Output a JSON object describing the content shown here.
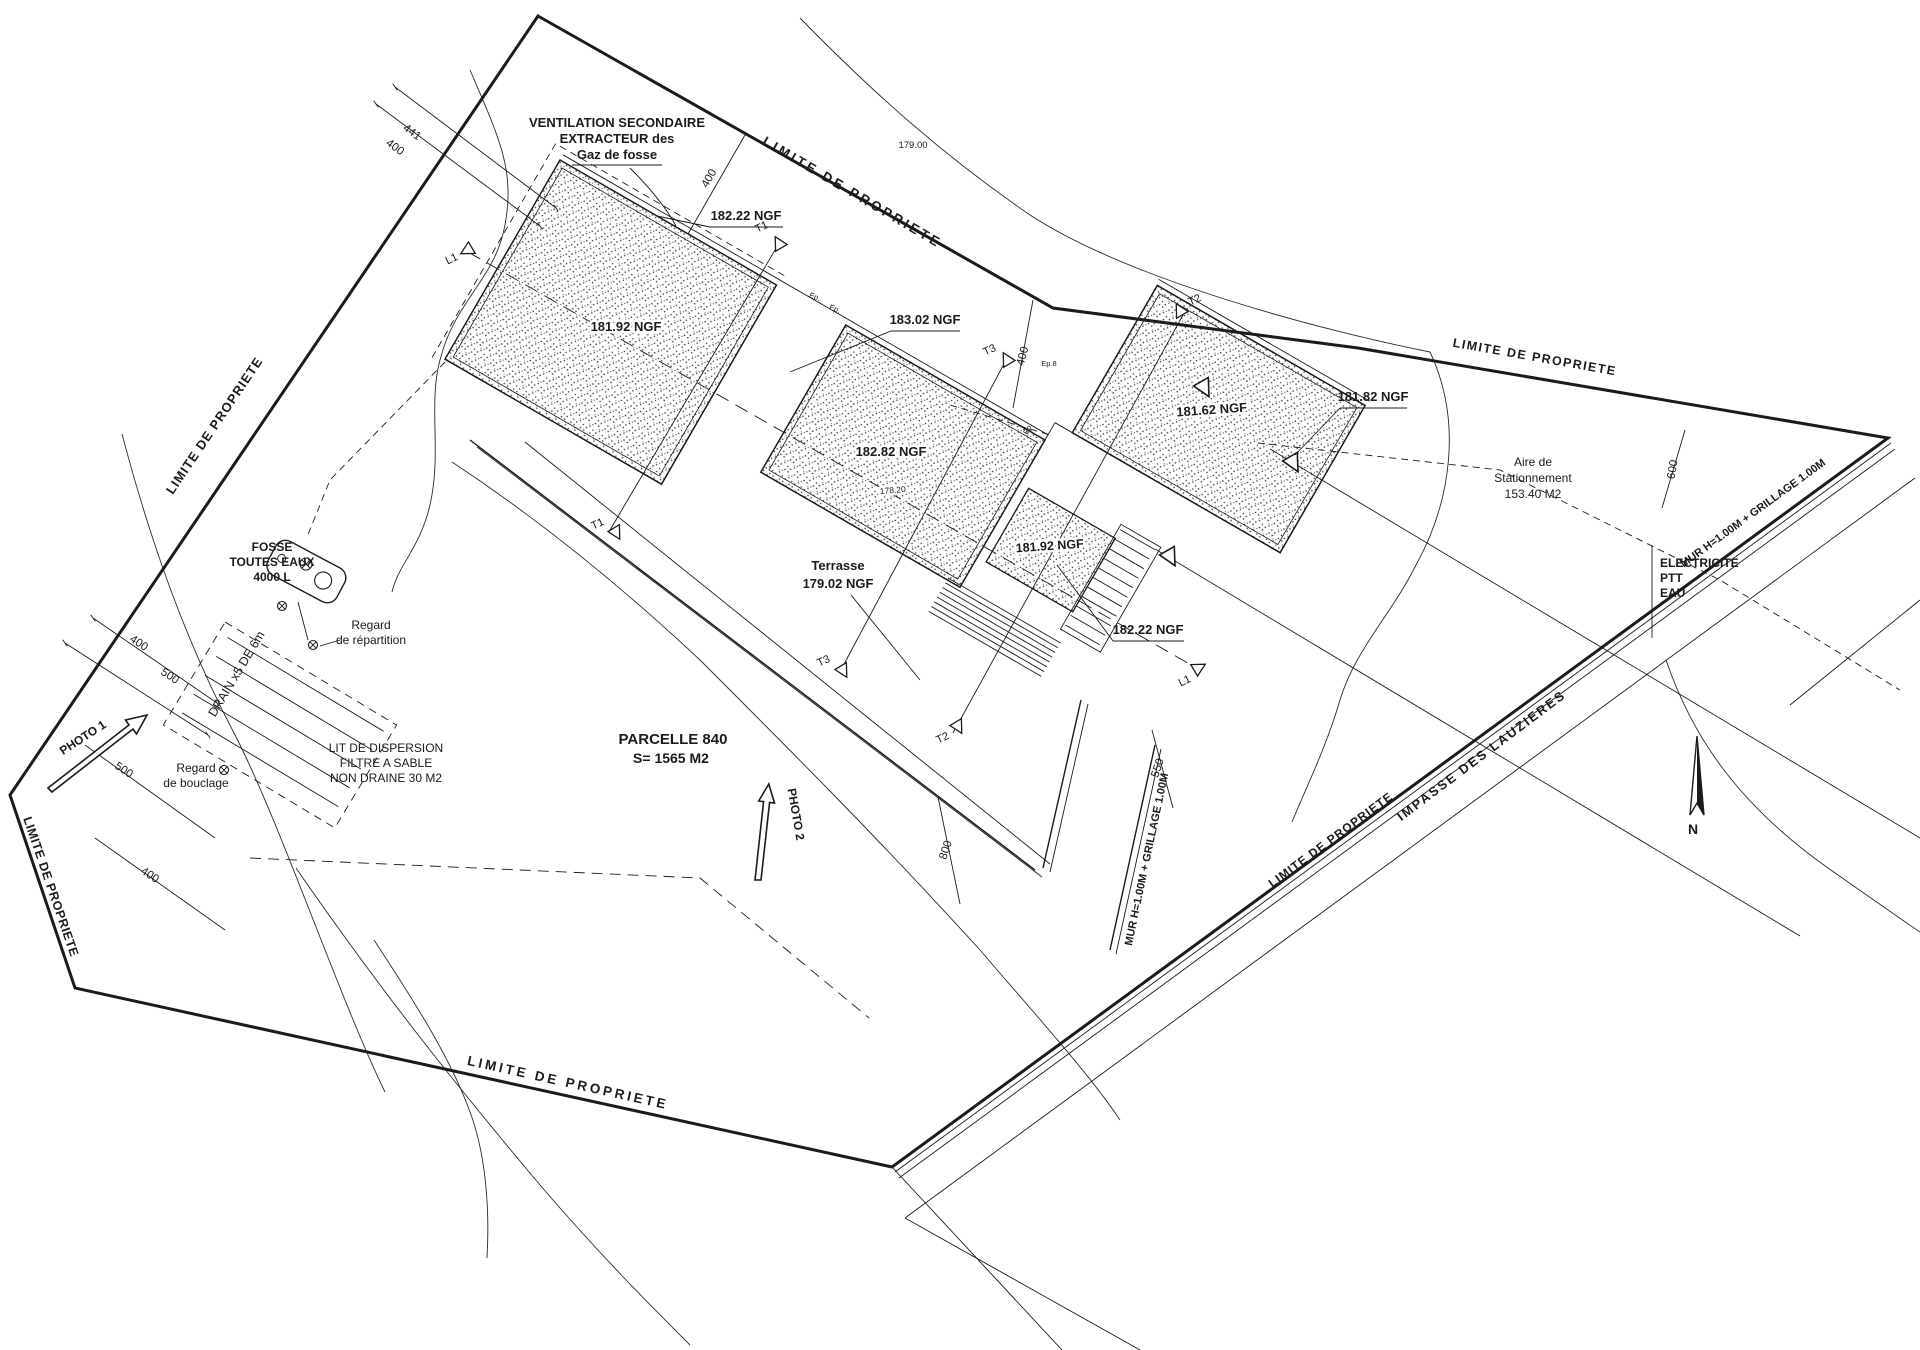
{
  "page": {
    "background": "#ffffff",
    "ink": "#1b1b1b"
  },
  "plan": {
    "parcel": {
      "name": "PARCELLE 840",
      "area": "S= 1565 M2"
    },
    "boundary_label": "LIMITE DE PROPRIETE",
    "road": {
      "name": "IMPASSE DES LAUZIERES",
      "wall": "MUR H=1.00M + GRILLAGE 1.00M"
    },
    "utilities": {
      "line1": "ELECTRICITE",
      "line2": "PTT",
      "line3": "EAU"
    },
    "north_label": "N",
    "contours": {
      "c179": "179.00",
      "c178": "178.20"
    },
    "levels": {
      "ngf_182_22": "182.22 NGF",
      "ngf_181_92": "181.92 NGF",
      "ngf_183_02": "183.02 NGF",
      "ngf_182_82": "182.82 NGF",
      "ngf_181_62": "181.62 NGF",
      "ngf_181_82": "181.82 NGF"
    },
    "terrace": {
      "line1": "Terrasse",
      "line2": "179.02 NGF"
    },
    "parking": {
      "line1": "Aire de",
      "line2": "Stationnement",
      "line3": "153.40 M2"
    },
    "ventilation": {
      "line1": "VENTILATION SECONDAIRE",
      "line2": "EXTRACTEUR des",
      "line3": "Gaz de fosse"
    },
    "septic": {
      "tank": {
        "line1": "FOSSE",
        "line2": "TOUTES EAUX",
        "line3": "4000 L"
      },
      "distribution_box": {
        "line1": "Regard",
        "line2": "de répartition"
      },
      "loop_box": {
        "line1": "Regard",
        "line2": "de bouclage"
      },
      "drain": "DRAIN x5 DE 6m",
      "bed": {
        "line1": "LIT DE DISPERSION",
        "line2": "FILTRE A SABLE",
        "line3": "NON DRAINE 30 M2"
      }
    },
    "photos": {
      "photo1": "PHOTO 1",
      "photo2": "PHOTO 2"
    },
    "dimensions": {
      "d441": "441",
      "d400": "400",
      "d500": "500",
      "d550": "550",
      "d600": "600",
      "d800": "800"
    },
    "markers": {
      "t1": "T1",
      "t2": "T2",
      "t3": "T3",
      "l1": "L1"
    },
    "wall_notes": {
      "ep": "Ep.",
      "ep8": "Ep.8"
    }
  }
}
